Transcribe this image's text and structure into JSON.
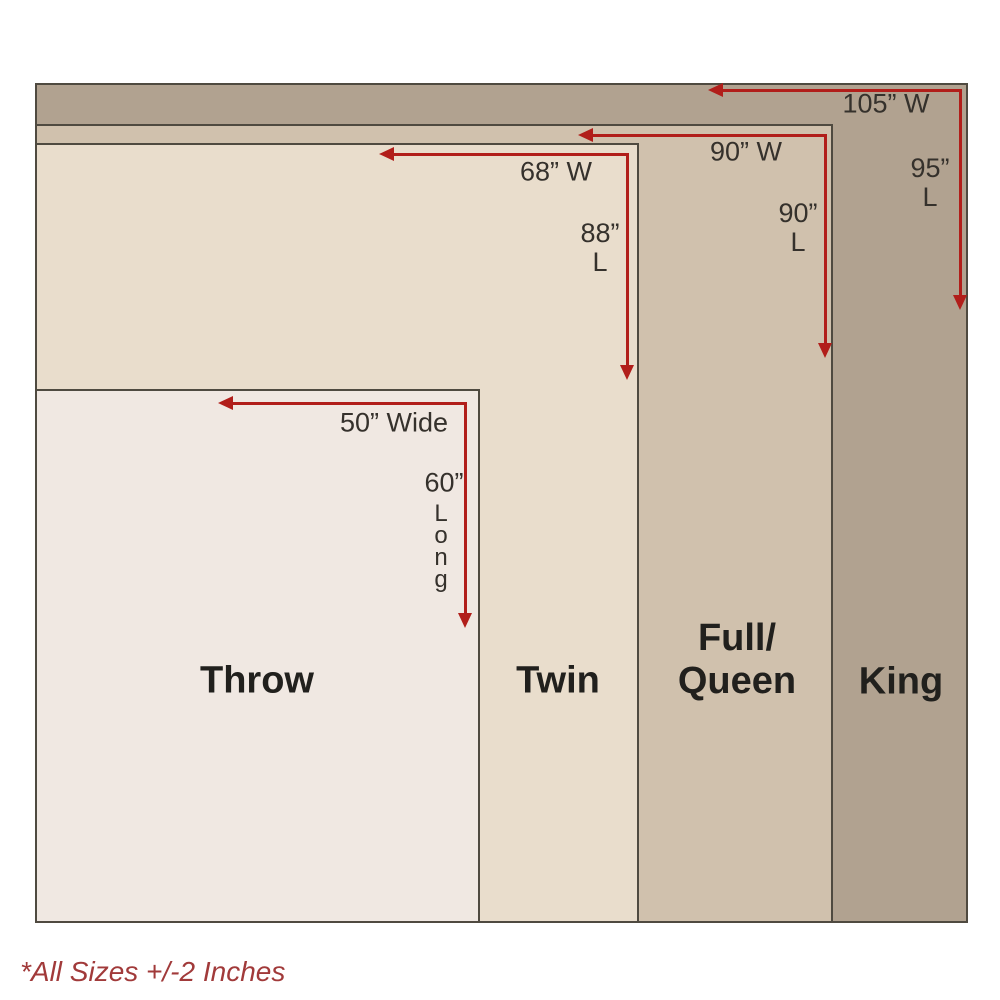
{
  "footnote": "*All Sizes +/-2 Inches",
  "colors": {
    "background": "#ffffff",
    "king_fill": "#b1a290",
    "full_queen_fill": "#d0c1ad",
    "twin_fill": "#e9ddcc",
    "throw_fill": "#f0e8e2",
    "border": "#4f4a40",
    "arrow_red": "#b11e1a",
    "dimension_text": "#35312c",
    "label_text": "#21201d",
    "footnote_red": "#a13a3a"
  },
  "sizes": [
    {
      "name": "Throw",
      "width_label": "50” Wide",
      "length_number": "60”",
      "length_word": "Long",
      "width_inches": 50,
      "length_inches": 60
    },
    {
      "name": "Twin",
      "width_label": "68” W",
      "length_number": "88”",
      "length_unit": "L",
      "width_inches": 68,
      "length_inches": 88
    },
    {
      "name": "Full/Queen",
      "name_line1": "Full/",
      "name_line2": "Queen",
      "width_label": "90” W",
      "length_number": "90”",
      "length_unit": "L",
      "width_inches": 90,
      "length_inches": 90
    },
    {
      "name": "King",
      "width_label": "105” W",
      "length_number": "95”",
      "length_unit": "L",
      "width_inches": 105,
      "length_inches": 95
    }
  ]
}
